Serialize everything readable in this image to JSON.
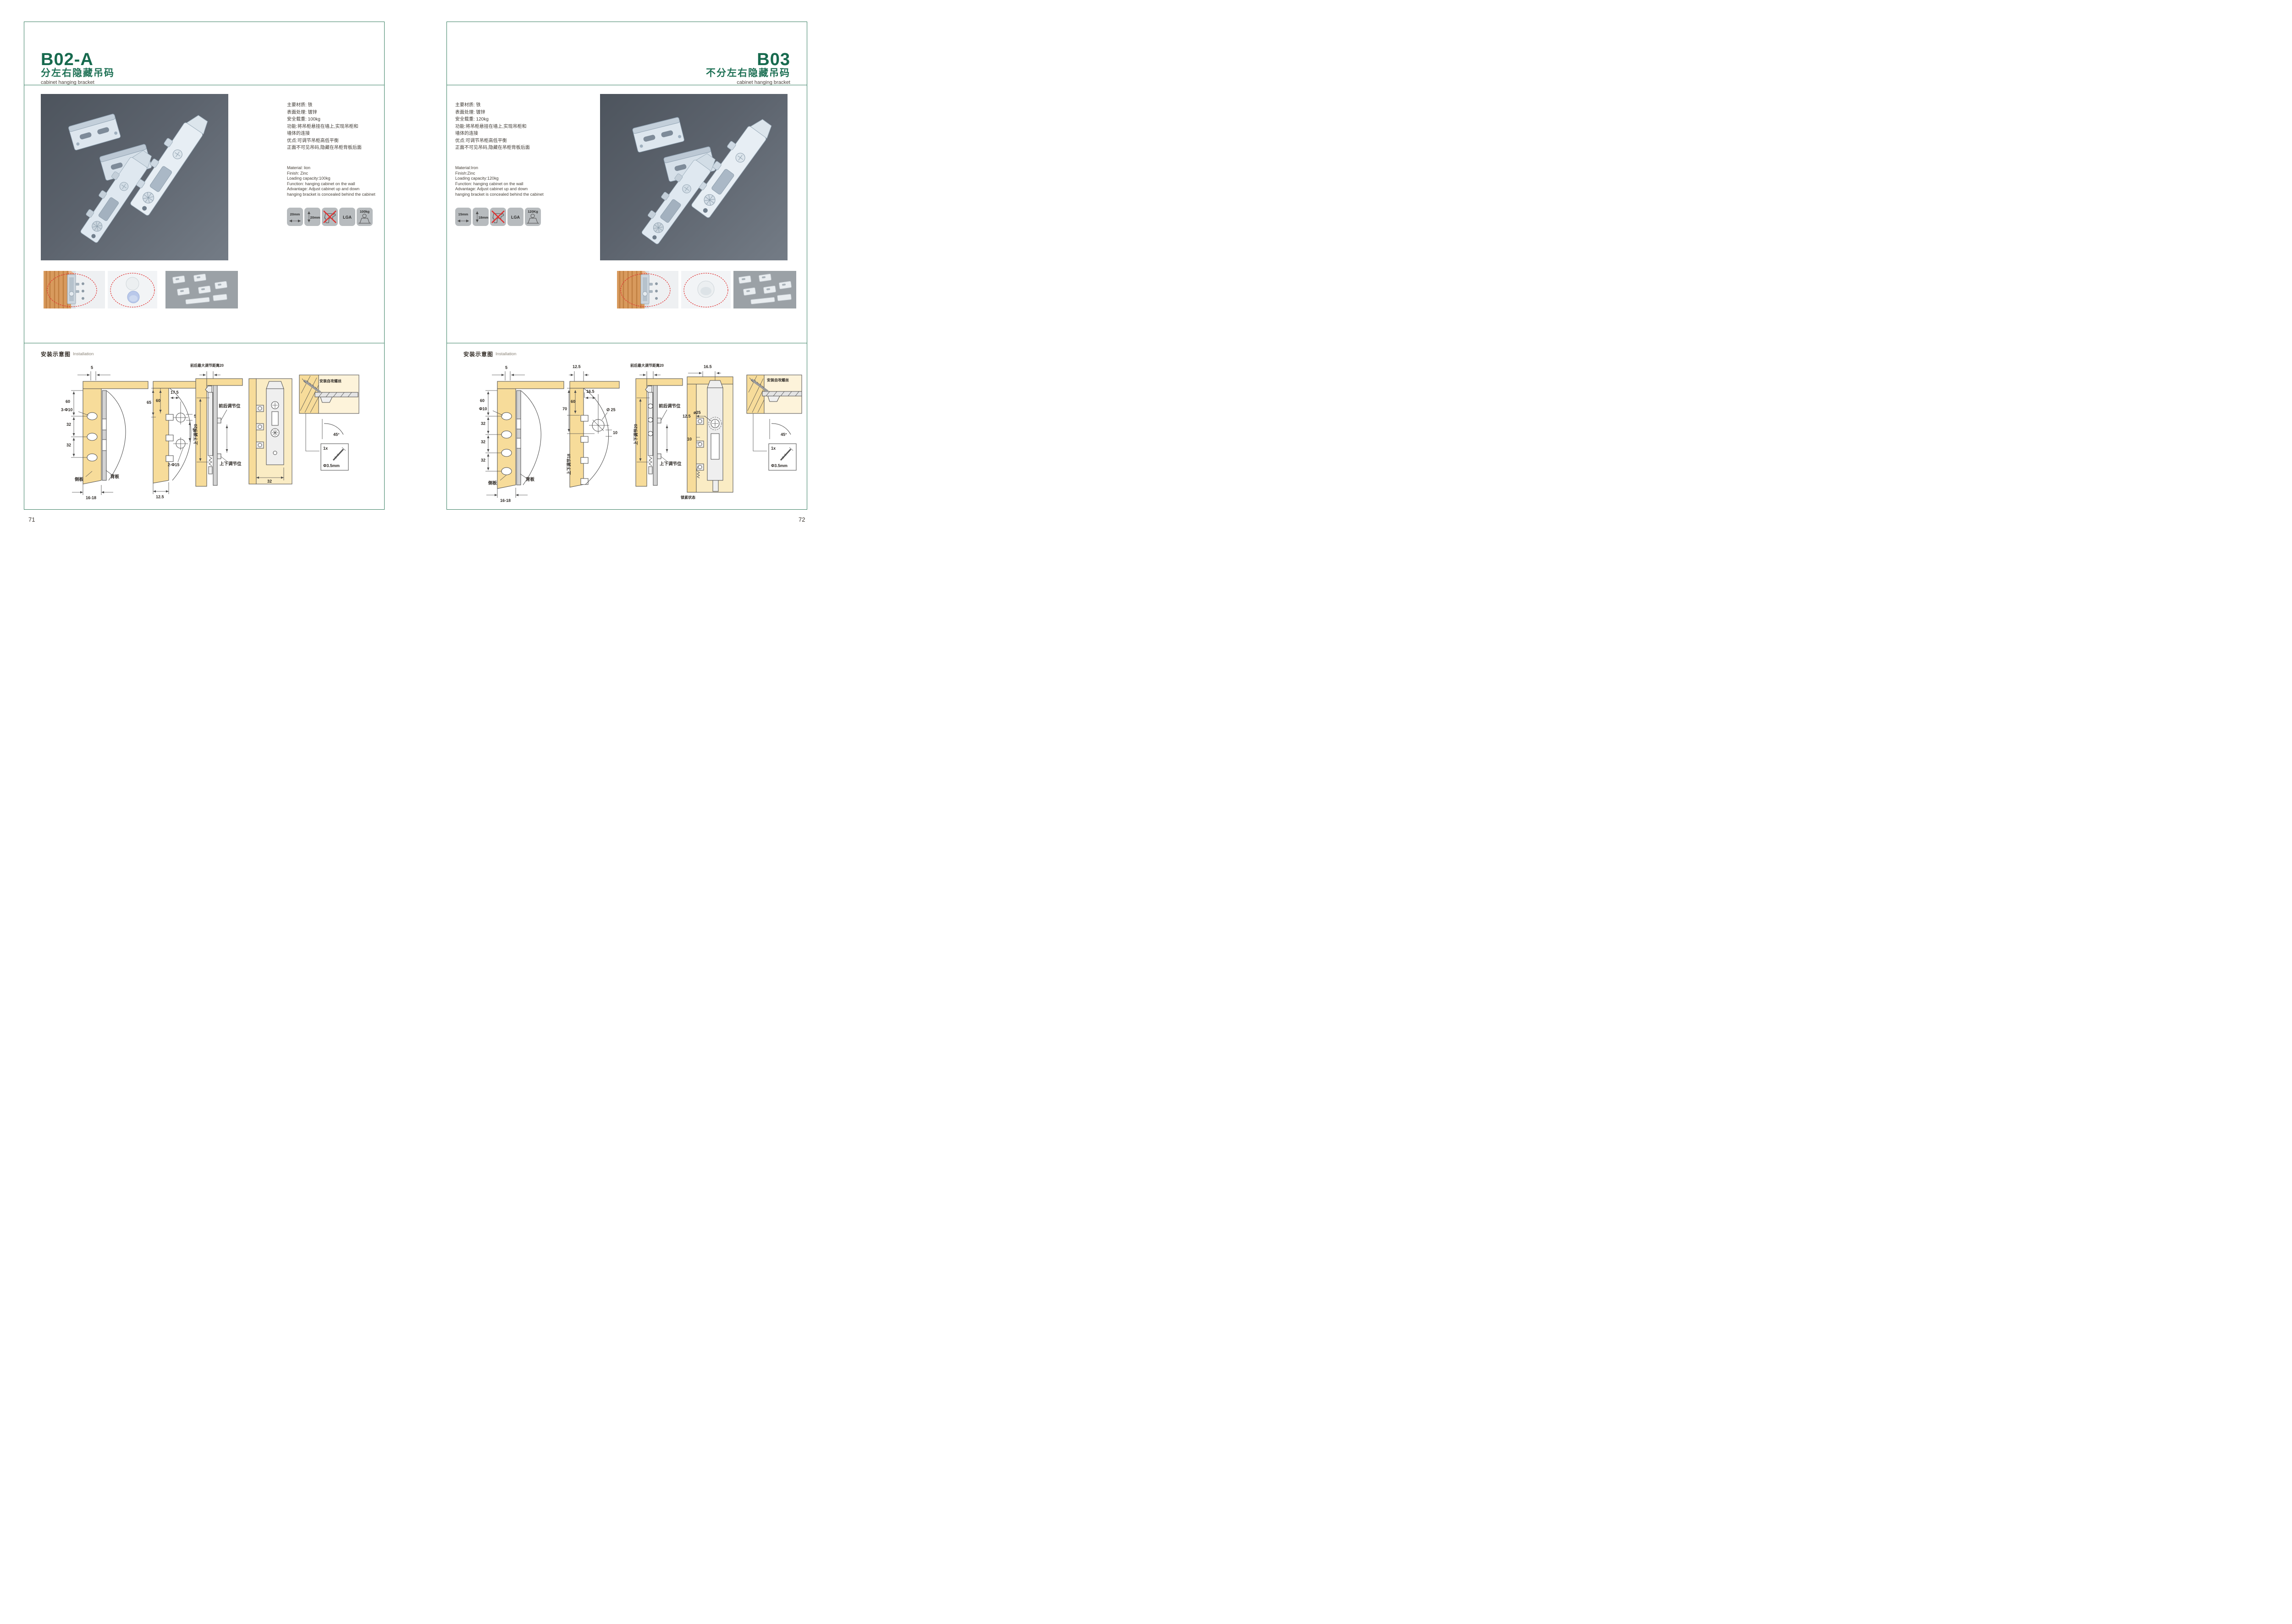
{
  "accent_green": "#176a4e",
  "pages": [
    {
      "code": "B02-A",
      "title_cn": "分左右隐藏吊码",
      "title_en": "cabinet hanging bracket",
      "page_number": "71",
      "specs_cn": [
        "主要材质: 铁",
        "表面处理: 镀锌",
        "安全载重: 100kg",
        "功能:将吊柜悬挂在墙上,实现吊柜和",
        "墙体的连接",
        "优点:可调节吊柜高低平衡",
        "正面不可见吊码,隐藏在吊柜背板后面"
      ],
      "specs_en": [
        "Material: lion",
        "Finish: Zinc",
        "Loading capacity:100kg",
        "Function: hanging cabinet on the wall",
        "Advantage: Adjust cabinet up and down",
        "hanging bracket is concealed behind the cabinet"
      ],
      "icons": {
        "h": "20mm",
        "v": "20mm",
        "cert": "LGA",
        "load": "100kg"
      },
      "install_cn": "安装示意图",
      "install_en": "Installation",
      "diagrams": {
        "d1": {
          "top": "5",
          "d60": "60",
          "hole": "3-Φ10",
          "d32a": "32",
          "d32b": "32",
          "side": "侧板",
          "back": "背板",
          "bottom": "16-18"
        },
        "d2": {
          "top": "17.5",
          "d65": "65",
          "d60": "60",
          "d5": "5",
          "d50": "50",
          "hole": "2-Φ15",
          "bottom": "12.5"
        },
        "d3": {
          "top": "前后最大调节距离20",
          "vert": "上下调节20",
          "fr": "前后调节位",
          "ud": "上下调节位"
        },
        "d4": {
          "dim": "32"
        },
        "detail": {
          "screw": "安装自攻螺丝",
          "angle": "45°",
          "qty": "1x",
          "dia": "Φ3.5mm"
        }
      }
    },
    {
      "code": "B03",
      "title_cn": "不分左右隐藏吊码",
      "title_en": "cabinet hanging bracket",
      "page_number": "72",
      "specs_cn": [
        "主要材质: 铁",
        "表面处理: 镀锌",
        "安全载重: 120kg",
        "功能:将吊柜悬挂在墙上,实现吊柜和",
        "墙体的连接",
        "优点:可调节吊柜高低平衡",
        "正面不可见吊码,隐藏在吊柜背板后面"
      ],
      "specs_en": [
        "Material:Iron",
        "Finish:Zinc",
        "Loading capacity:120kg",
        "Function: hanging cabinet on the wall",
        "Advantage: Adjust cabinet up and down",
        "hanging bracket is concealed behind the cabinet"
      ],
      "icons": {
        "h": "15mm",
        "v": "18mm",
        "cert": "LGA",
        "load": "120Kg"
      },
      "install_cn": "安装示意图",
      "install_en": "Installation",
      "diagrams": {
        "d1": {
          "top": "5",
          "d60": "60",
          "hole": "Φ10",
          "d32a": "32",
          "d32b": "32",
          "d32c": "32",
          "side": "侧板",
          "back": "背板",
          "bottom": "16-18"
        },
        "d2": {
          "top": "12.5",
          "t2": "16.5",
          "d70": "70",
          "d60": "60",
          "hole": "Ø 25",
          "d10": "10",
          "vert": "上下调节18"
        },
        "d3": {
          "top": "前后最大调节距离20",
          "vert": "上下调节20",
          "fr": "前后调节位",
          "ud": "上下调节位"
        },
        "d4": {
          "top": "16.5",
          "left": "12.5",
          "d10": "10",
          "hole": "ø25",
          "state": "锁紧状态"
        },
        "detail": {
          "screw": "安装自攻螺丝",
          "angle": "45°",
          "qty": "1x",
          "dia": "Φ3.5mm"
        }
      }
    }
  ]
}
